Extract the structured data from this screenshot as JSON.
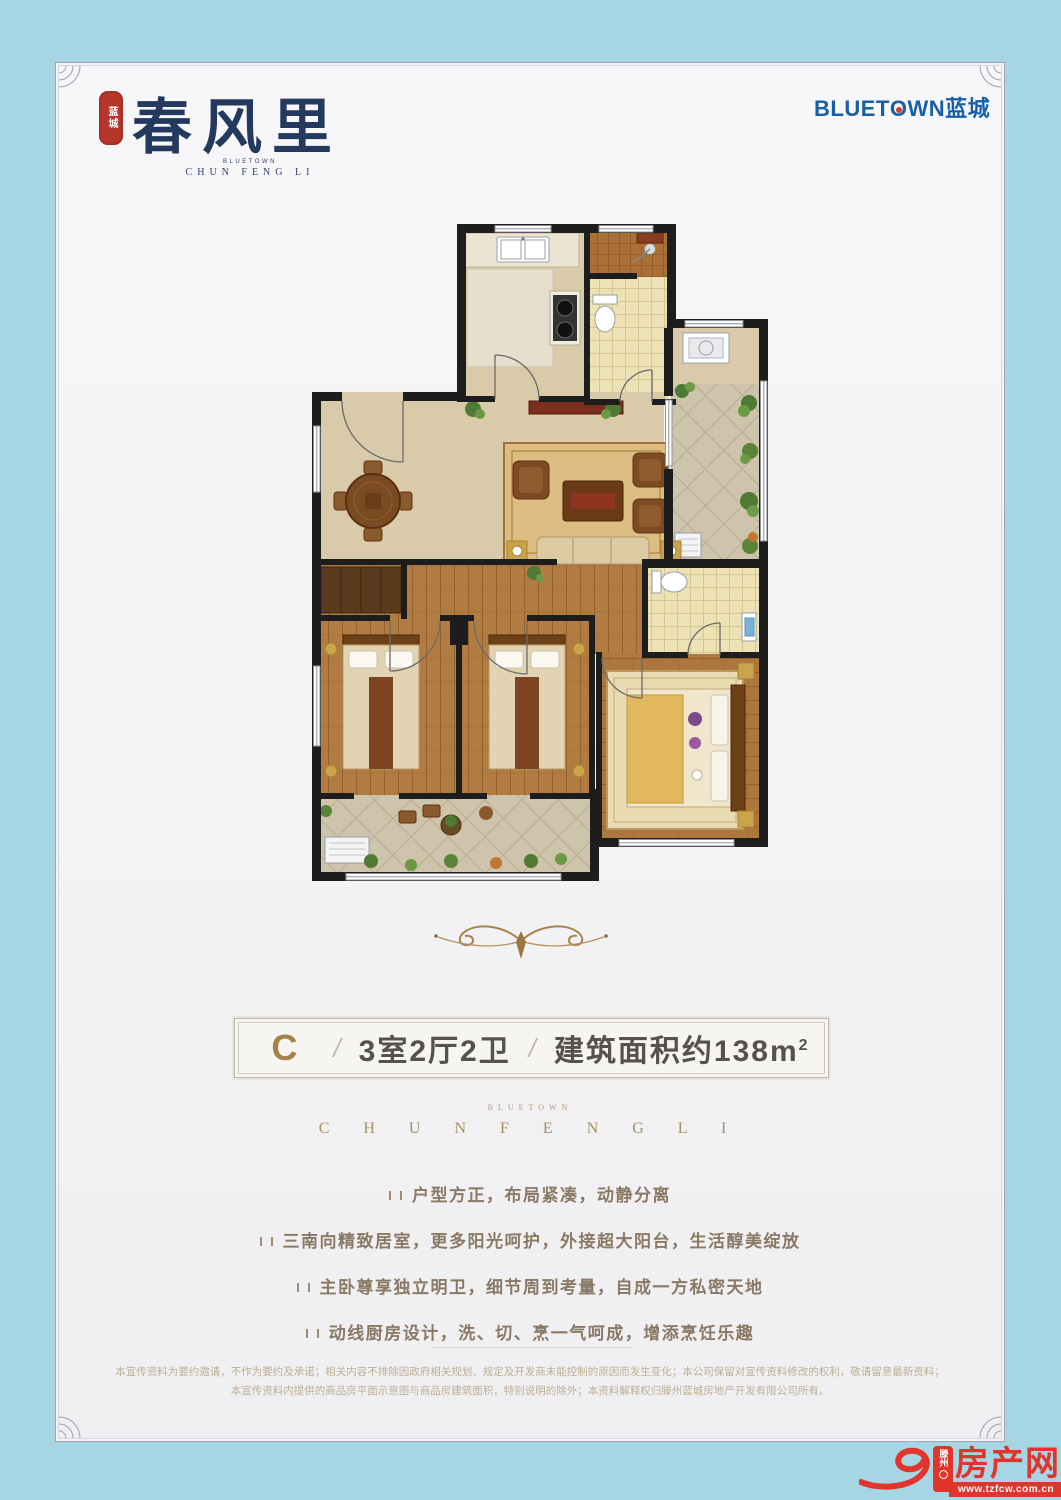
{
  "header": {
    "seal_text": "蓝城",
    "title": "春风里",
    "subtitle_small": "BLUETOWN",
    "subtitle_large": "CHUN FENG LI",
    "brand_part1": "BLUET",
    "brand_part2": "O",
    "brand_part3": "WN",
    "brand_cn": "蓝城"
  },
  "floorplan": {
    "type": "apartment-floor-plan",
    "depicted": "厨房、卫生间、餐厅、客厅、三卧室、主卫、洗衣区、三阳台"
  },
  "banner": {
    "code": "C",
    "separator": "/",
    "rooms": "3室2厅2卫",
    "area": "建筑面积约138m",
    "area_sup": "2"
  },
  "midbrand": {
    "small": "BLUETOWN",
    "large": "C H U N   F E N G   L I"
  },
  "features": {
    "items": [
      "户型方正，布局紧凑，动静分离",
      "三南向精致居室，更多阳光呵护，外接超大阳台，生活醇美绽放",
      "主卧尊享独立明卫，细节周到考量，自成一方私密天地",
      "动线厨房设计，洗、切、烹一气呵成，增添烹饪乐趣"
    ]
  },
  "ticks_row": "· · · · · · · · · · · · ·",
  "disclaimer": {
    "line1": "本宣传资料为要约邀请，不作为要约及承诺；相关内容不排除因政府相关规划、规定及开发商未能控制的原因而发生变化；本公司保留对宣传资料修改的权利，敬请留意最新资料；",
    "line2": "本宣传资料内提供的商品房平面示意图与商品房建筑面积，特别说明的除外；本资料解释权归滕州蓝城房地产开发有限公司所有。"
  },
  "footer_logo": {
    "region": "滕州",
    "name": "房产网",
    "url": "www.tzfcw.com.cn"
  },
  "icons": {
    "bullet": "double-bar-bullet",
    "corner_ornament": "fan-arcs",
    "flourish": "scroll-ornament",
    "e_swoosh": "stylized-letter-e"
  },
  "colors": {
    "background_blue": "#a6d6e4",
    "page": "#f5f5f7",
    "brand_navy": "#24395e",
    "brand_blue": "#1760a8",
    "seal_red": "#b5362a",
    "banner_gold": "#a3824c",
    "banner_text": "#55514b",
    "bronze": "#a78f63",
    "feature_text": "#8a7964",
    "disclaimer_text": "#bdaf93",
    "footer_red": "#e0342c",
    "wall_black": "#1d1d1d",
    "floor_tan": "#d9cba9",
    "floor_wood": "#b07c42"
  }
}
